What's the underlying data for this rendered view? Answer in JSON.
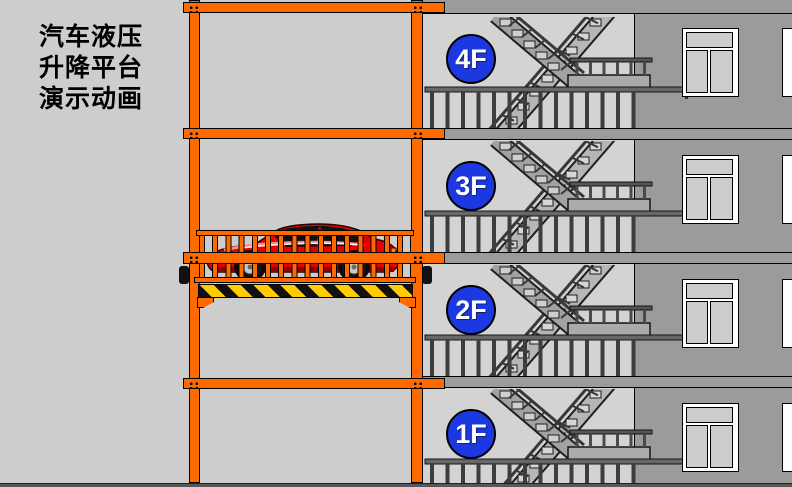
{
  "page": {
    "title_lines": [
      "汽车液压",
      "升降平台",
      "演示动画"
    ]
  },
  "building": {
    "floors": [
      {
        "label": "4F"
      },
      {
        "label": "3F"
      },
      {
        "label": "2F"
      },
      {
        "label": "1F"
      }
    ]
  },
  "lift": {
    "beam_count": 4,
    "platform_floor_position": "between 2F and 3F",
    "cargo": "red sports car"
  },
  "colors": {
    "frame_orange": "#ff6a00",
    "badge_blue": "#1c38e0",
    "badge_text": "#ffffff",
    "car_red": "#e80000",
    "hazard_yellow": "#ffcc00",
    "hazard_black": "#111111",
    "wall_gray": "#9b9b9b",
    "stairwell_gray": "#d3d3d3",
    "bg_gray": "#cdcdcd",
    "ground_gray": "#585858"
  }
}
